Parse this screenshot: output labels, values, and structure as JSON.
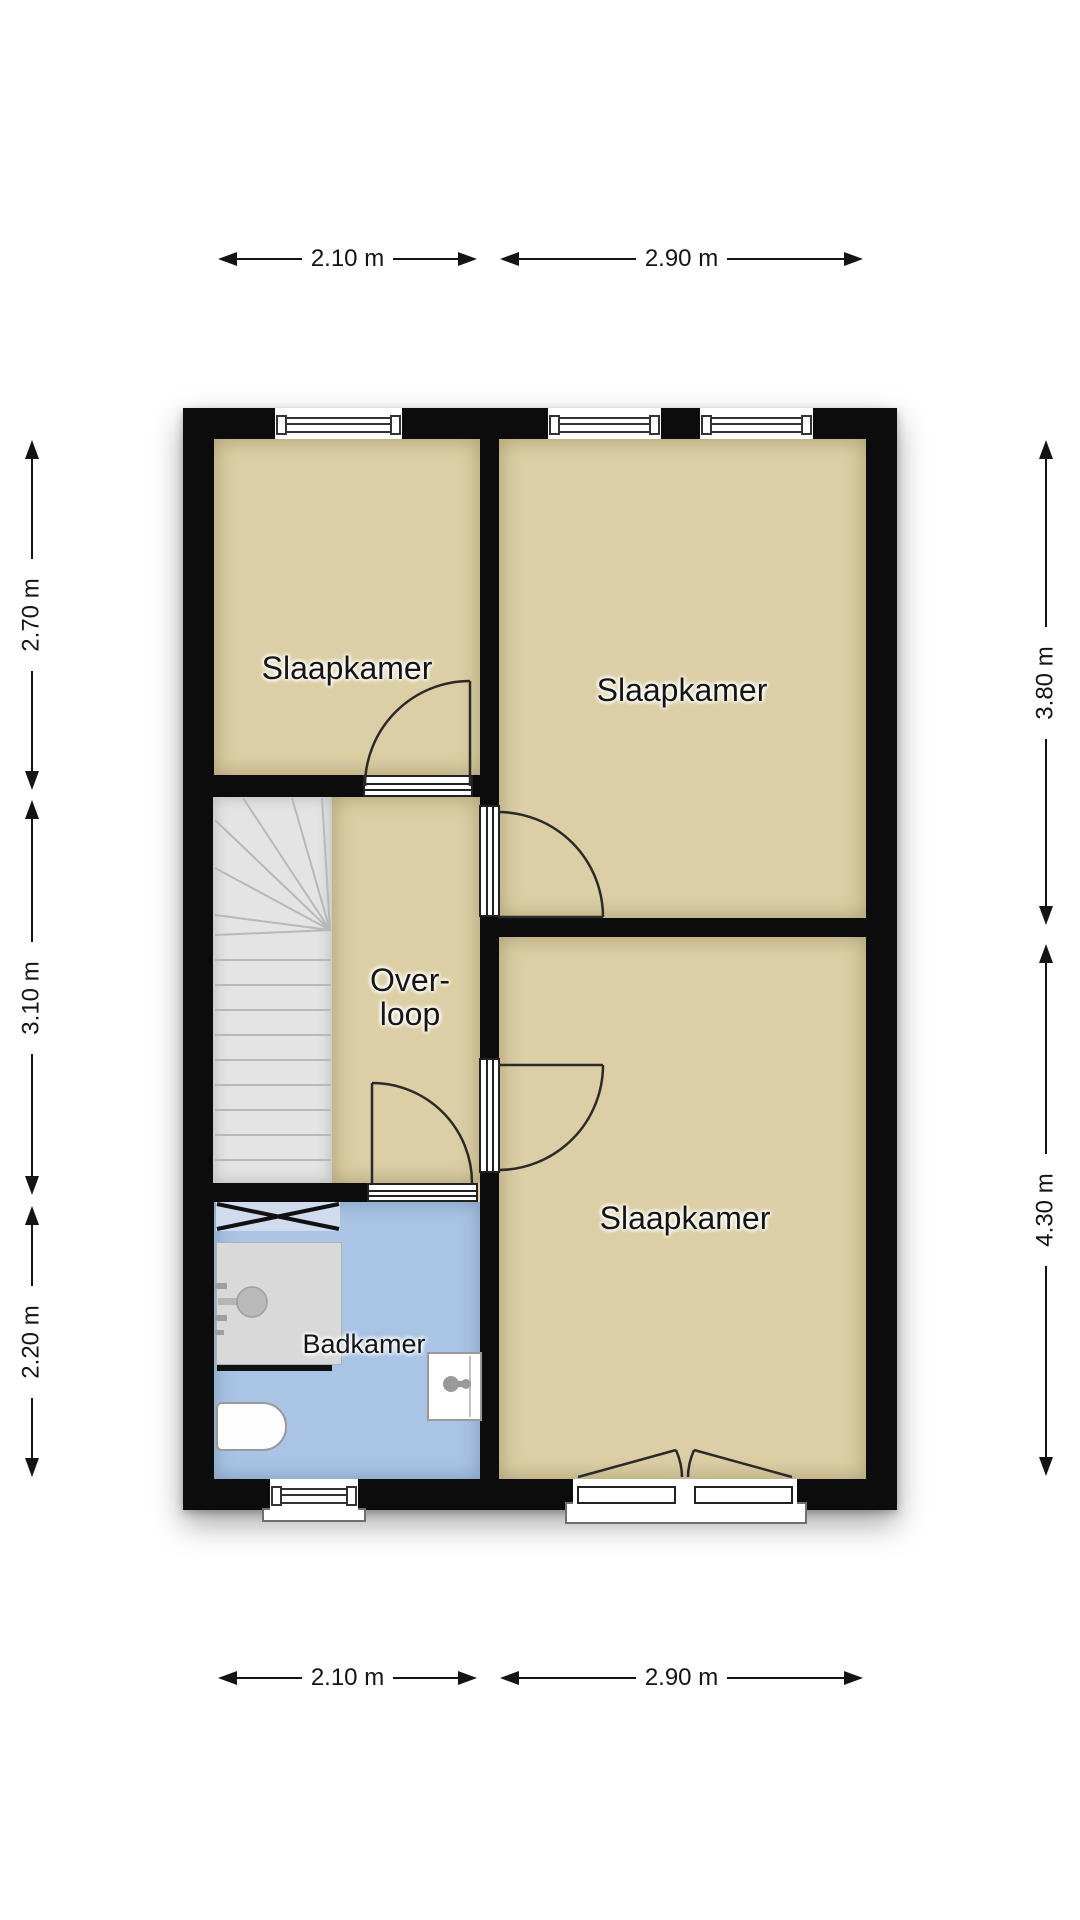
{
  "plan_type": "floor-plan",
  "rooms": {
    "bedroom_top_left": "Slaapkamer",
    "bedroom_top_right": "Slaapkamer",
    "bedroom_bottom_right": "Slaapkamer",
    "landing_line1": "Over-",
    "landing_line2": "loop",
    "bathroom": "Badkamer"
  },
  "dimensions": {
    "top": [
      "2.10 m",
      "2.90 m"
    ],
    "bottom": [
      "2.10 m",
      "2.90 m"
    ],
    "left": [
      "2.70 m",
      "3.10 m",
      "2.20 m"
    ],
    "right": [
      "3.80 m",
      "4.30 m"
    ]
  },
  "colors": {
    "wall": "#0c0c0c",
    "floor": "#dccfa5",
    "bathroom_floor": "#a9c4e4",
    "stairs": "#e4e4e4",
    "stroke": "#2a2a2a"
  }
}
